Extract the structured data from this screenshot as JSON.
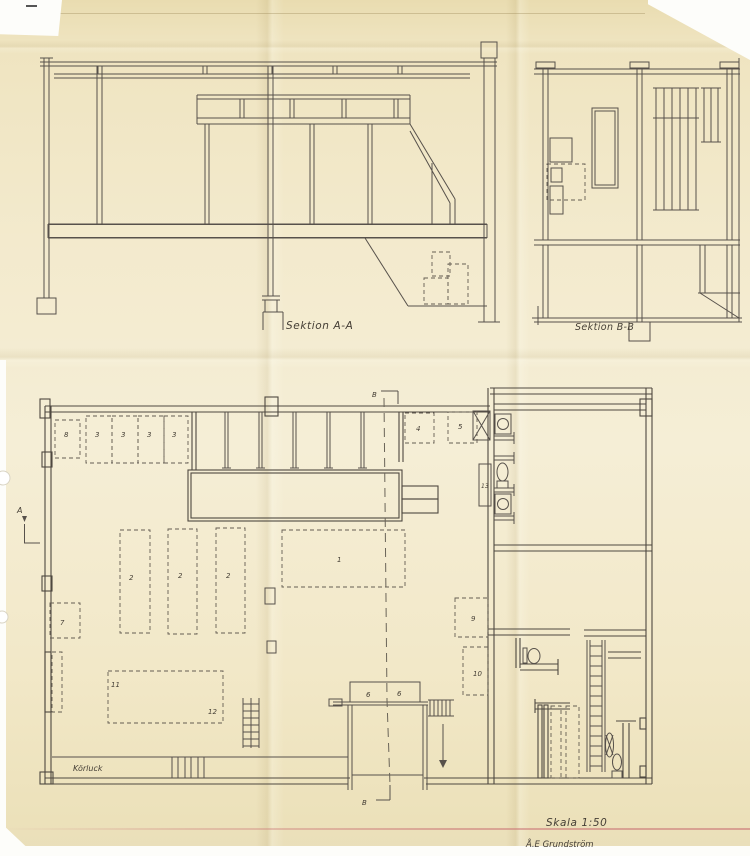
{
  "sheet": {
    "section_a_title": "Sektion A-A",
    "section_b_title": "Sektion B-B",
    "scale_label": "Skala 1:50",
    "signature": "Å.E Grundström",
    "dock_label": "Körluck",
    "marker_a": "A",
    "marker_b_top": "B",
    "marker_b_bottom": "B"
  },
  "plan": {
    "numbers": [
      "8",
      "3",
      "3",
      "3",
      "3",
      "4",
      "5",
      "13",
      "1",
      "2",
      "2",
      "2",
      "7",
      "9",
      "10",
      "11",
      "12",
      "6",
      "6"
    ]
  },
  "colors": {
    "paper": "#f2e8c9",
    "paper_dark": "#e9dcb0",
    "ink": "#57514b",
    "wall_ink": "#4e4840",
    "ruled_line": "#cb7676",
    "edge_white": "#fdfdfa"
  }
}
